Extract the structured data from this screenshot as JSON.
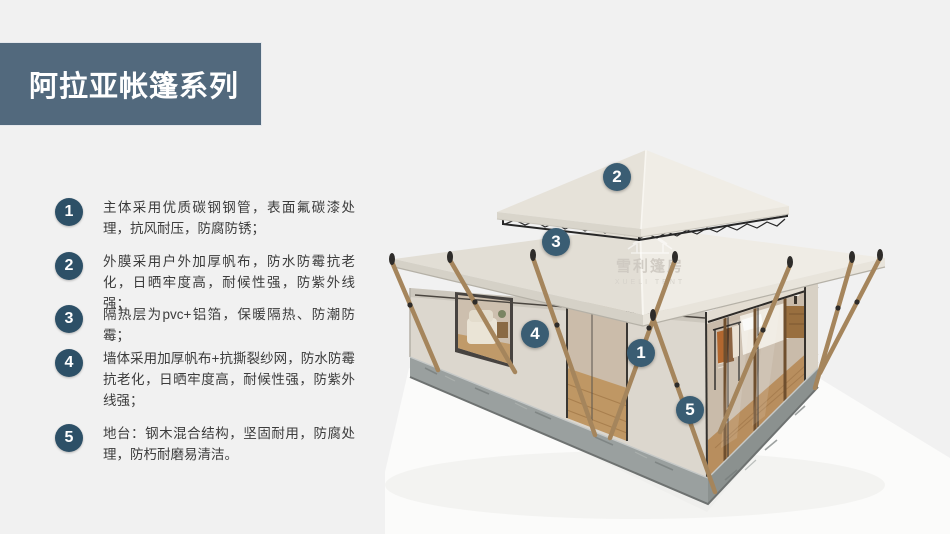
{
  "header": {
    "title": "阿拉亚帐篷系列",
    "banner_color": "#52697d",
    "title_color": "#ffffff"
  },
  "features": [
    {
      "num": "1",
      "text": "主体采用优质碳钢钢管，表面氟碳漆处理，抗风耐压，防腐防锈；"
    },
    {
      "num": "2",
      "text": "外膜采用户外加厚帆布，防水防霉抗老化，日晒牢度高，耐候性强，防紫外线强；"
    },
    {
      "num": "3",
      "text": "隔热层为pvc+铝箔，保暖隔热、防潮防霉；"
    },
    {
      "num": "4",
      "text": "墙体采用加厚帆布+抗撕裂纱网，防水防霉抗老化，日晒牢度高，耐候性强，防紫外线强；"
    },
    {
      "num": "5",
      "text": "地台：钢木混合结构，坚固耐用，防腐处理，防朽耐磨易清洁。"
    }
  ],
  "illustration": {
    "watermark": {
      "cn": "雪利篷房",
      "en": "XUELI TENT"
    },
    "callouts": [
      {
        "num": "1"
      },
      {
        "num": "2"
      },
      {
        "num": "3"
      },
      {
        "num": "4"
      },
      {
        "num": "5"
      }
    ],
    "colors": {
      "list_badge": "#2d5067",
      "image_badge": "#3a5d73",
      "roof_canvas_light": "#efece5",
      "roof_canvas_dark": "#e2ded5",
      "wall_canvas": "#dcd7ce",
      "platform_concrete": "#9aa09f",
      "wood_pole": "#a5855c",
      "wood_floor": "#bf9764",
      "background": "#f1f1f1"
    }
  }
}
